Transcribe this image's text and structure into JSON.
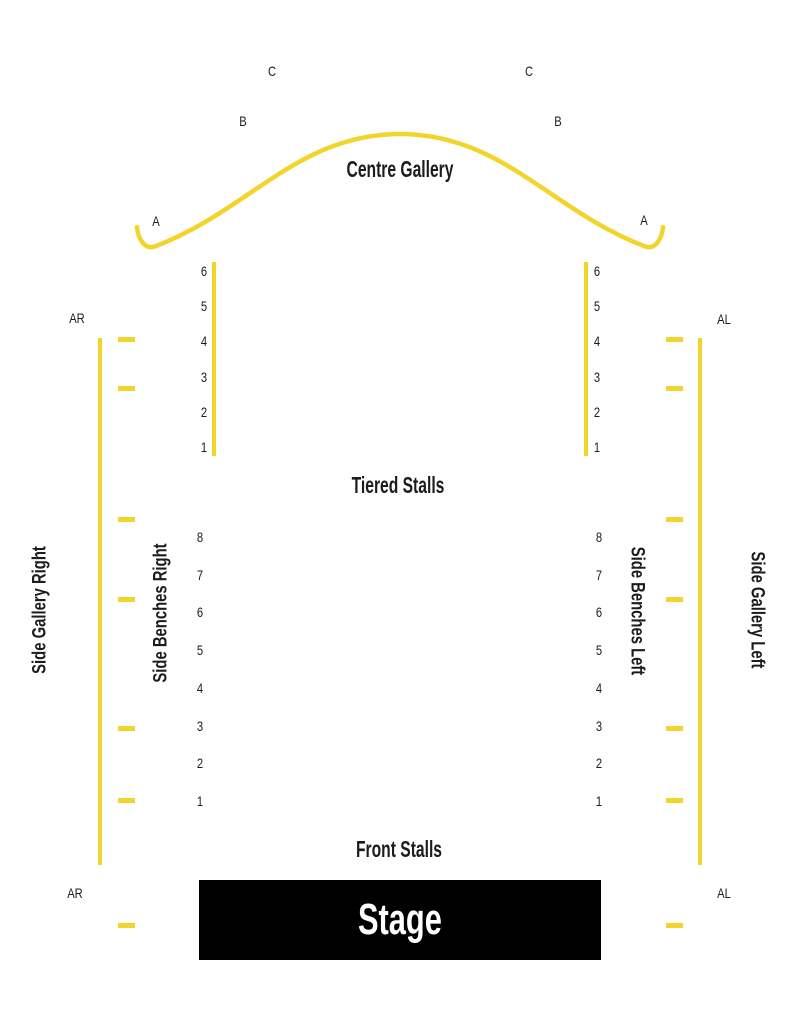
{
  "colors": {
    "accent": "#F3D42C",
    "stage_bg": "#000000",
    "stage_text": "#FFFFFF",
    "text": "#1C1C1C"
  },
  "centre_gallery": {
    "label": "Centre Gallery",
    "left_rows": [
      "C",
      "B",
      "A"
    ],
    "right_rows": [
      "C",
      "B",
      "A"
    ]
  },
  "tiered_stalls": {
    "label": "Tiered Stalls",
    "row_numbers": [
      "6",
      "5",
      "4",
      "3",
      "2",
      "1"
    ]
  },
  "side_benches_right": {
    "label": "Side Benches Right",
    "row_numbers": [
      "8",
      "7",
      "6",
      "5",
      "4",
      "3",
      "2",
      "1"
    ]
  },
  "side_benches_left": {
    "label": "Side Benches Left",
    "row_numbers": [
      "8",
      "7",
      "6",
      "5",
      "4",
      "3",
      "2",
      "1"
    ]
  },
  "side_gallery_right": {
    "label": "Side Gallery Right",
    "top_label": "AR",
    "bottom_label": "AR"
  },
  "side_gallery_left": {
    "label": "Side Gallery Left",
    "top_label": "AL",
    "bottom_label": "AL"
  },
  "front_stalls": {
    "label": "Front Stalls"
  },
  "stage": {
    "label": "Stage"
  }
}
